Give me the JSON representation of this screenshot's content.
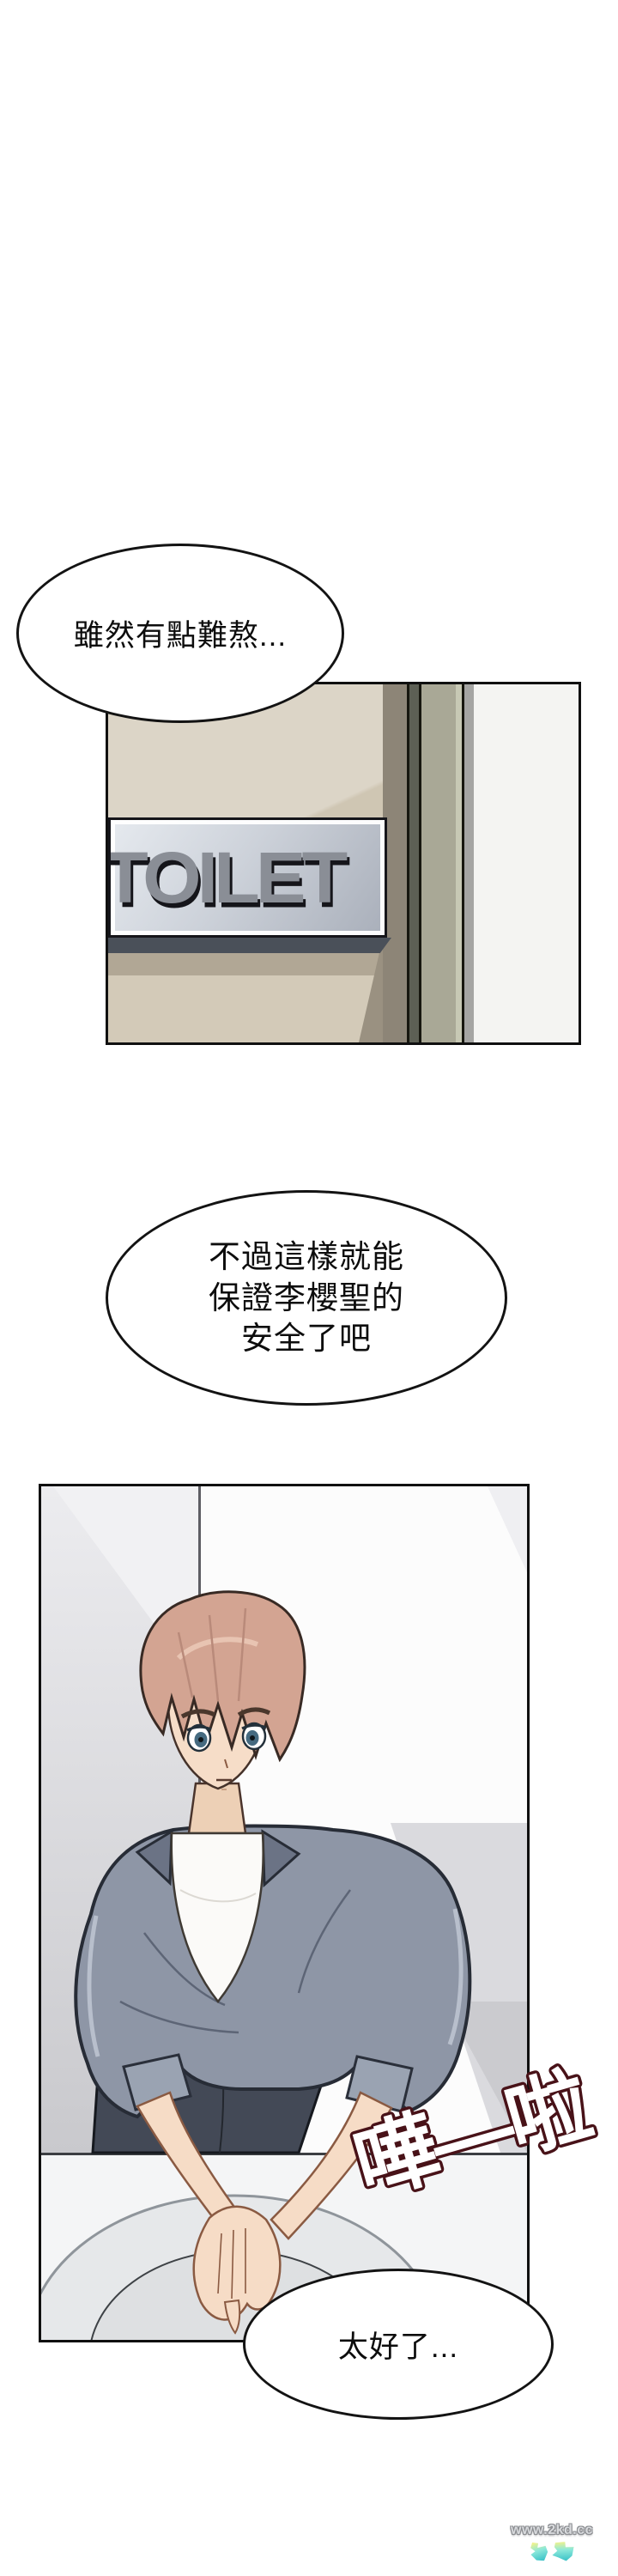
{
  "speech": {
    "bubble1": "雖然有點難熬...",
    "bubble2_lines": [
      "不過這樣就能",
      "保證李櫻聖的",
      "安全了吧"
    ],
    "bubble3": "太好了..."
  },
  "door_sign": {
    "label": "TOILET"
  },
  "sfx": {
    "splash": "嘩—啦"
  },
  "watermark": {
    "site": "www.2kd.cc"
  },
  "colors": {
    "panel_border": "#101010",
    "bubble_border": "#131313",
    "door_tan_light": "#dcd5c7",
    "door_tan_shadow": "#cfc6b3",
    "sign_plate_silver": "#cdd2da",
    "sign_letters": "#8a8e96",
    "sign_letter_shadow": "#15151a",
    "door_frame_dark": "#5d6055",
    "door_frame_green": "#a9a896",
    "wall_white": "#f4f4f2",
    "jacket_gray": "#8e96a6",
    "jacket_collar": "#6b7385",
    "hair_pink_brown": "#d3a492",
    "skin": "#f6dcc6",
    "skirt_dark": "#434956",
    "sink_counter": "#f4f5f6",
    "basin_gray": "#e6e8ea",
    "sfx_outline": "#481218",
    "sfx_fill": "#ffffff",
    "watermark_gray": "#8a8c90",
    "logo_teal": "#3fc4c9",
    "logo_yellow": "#eef28e"
  }
}
